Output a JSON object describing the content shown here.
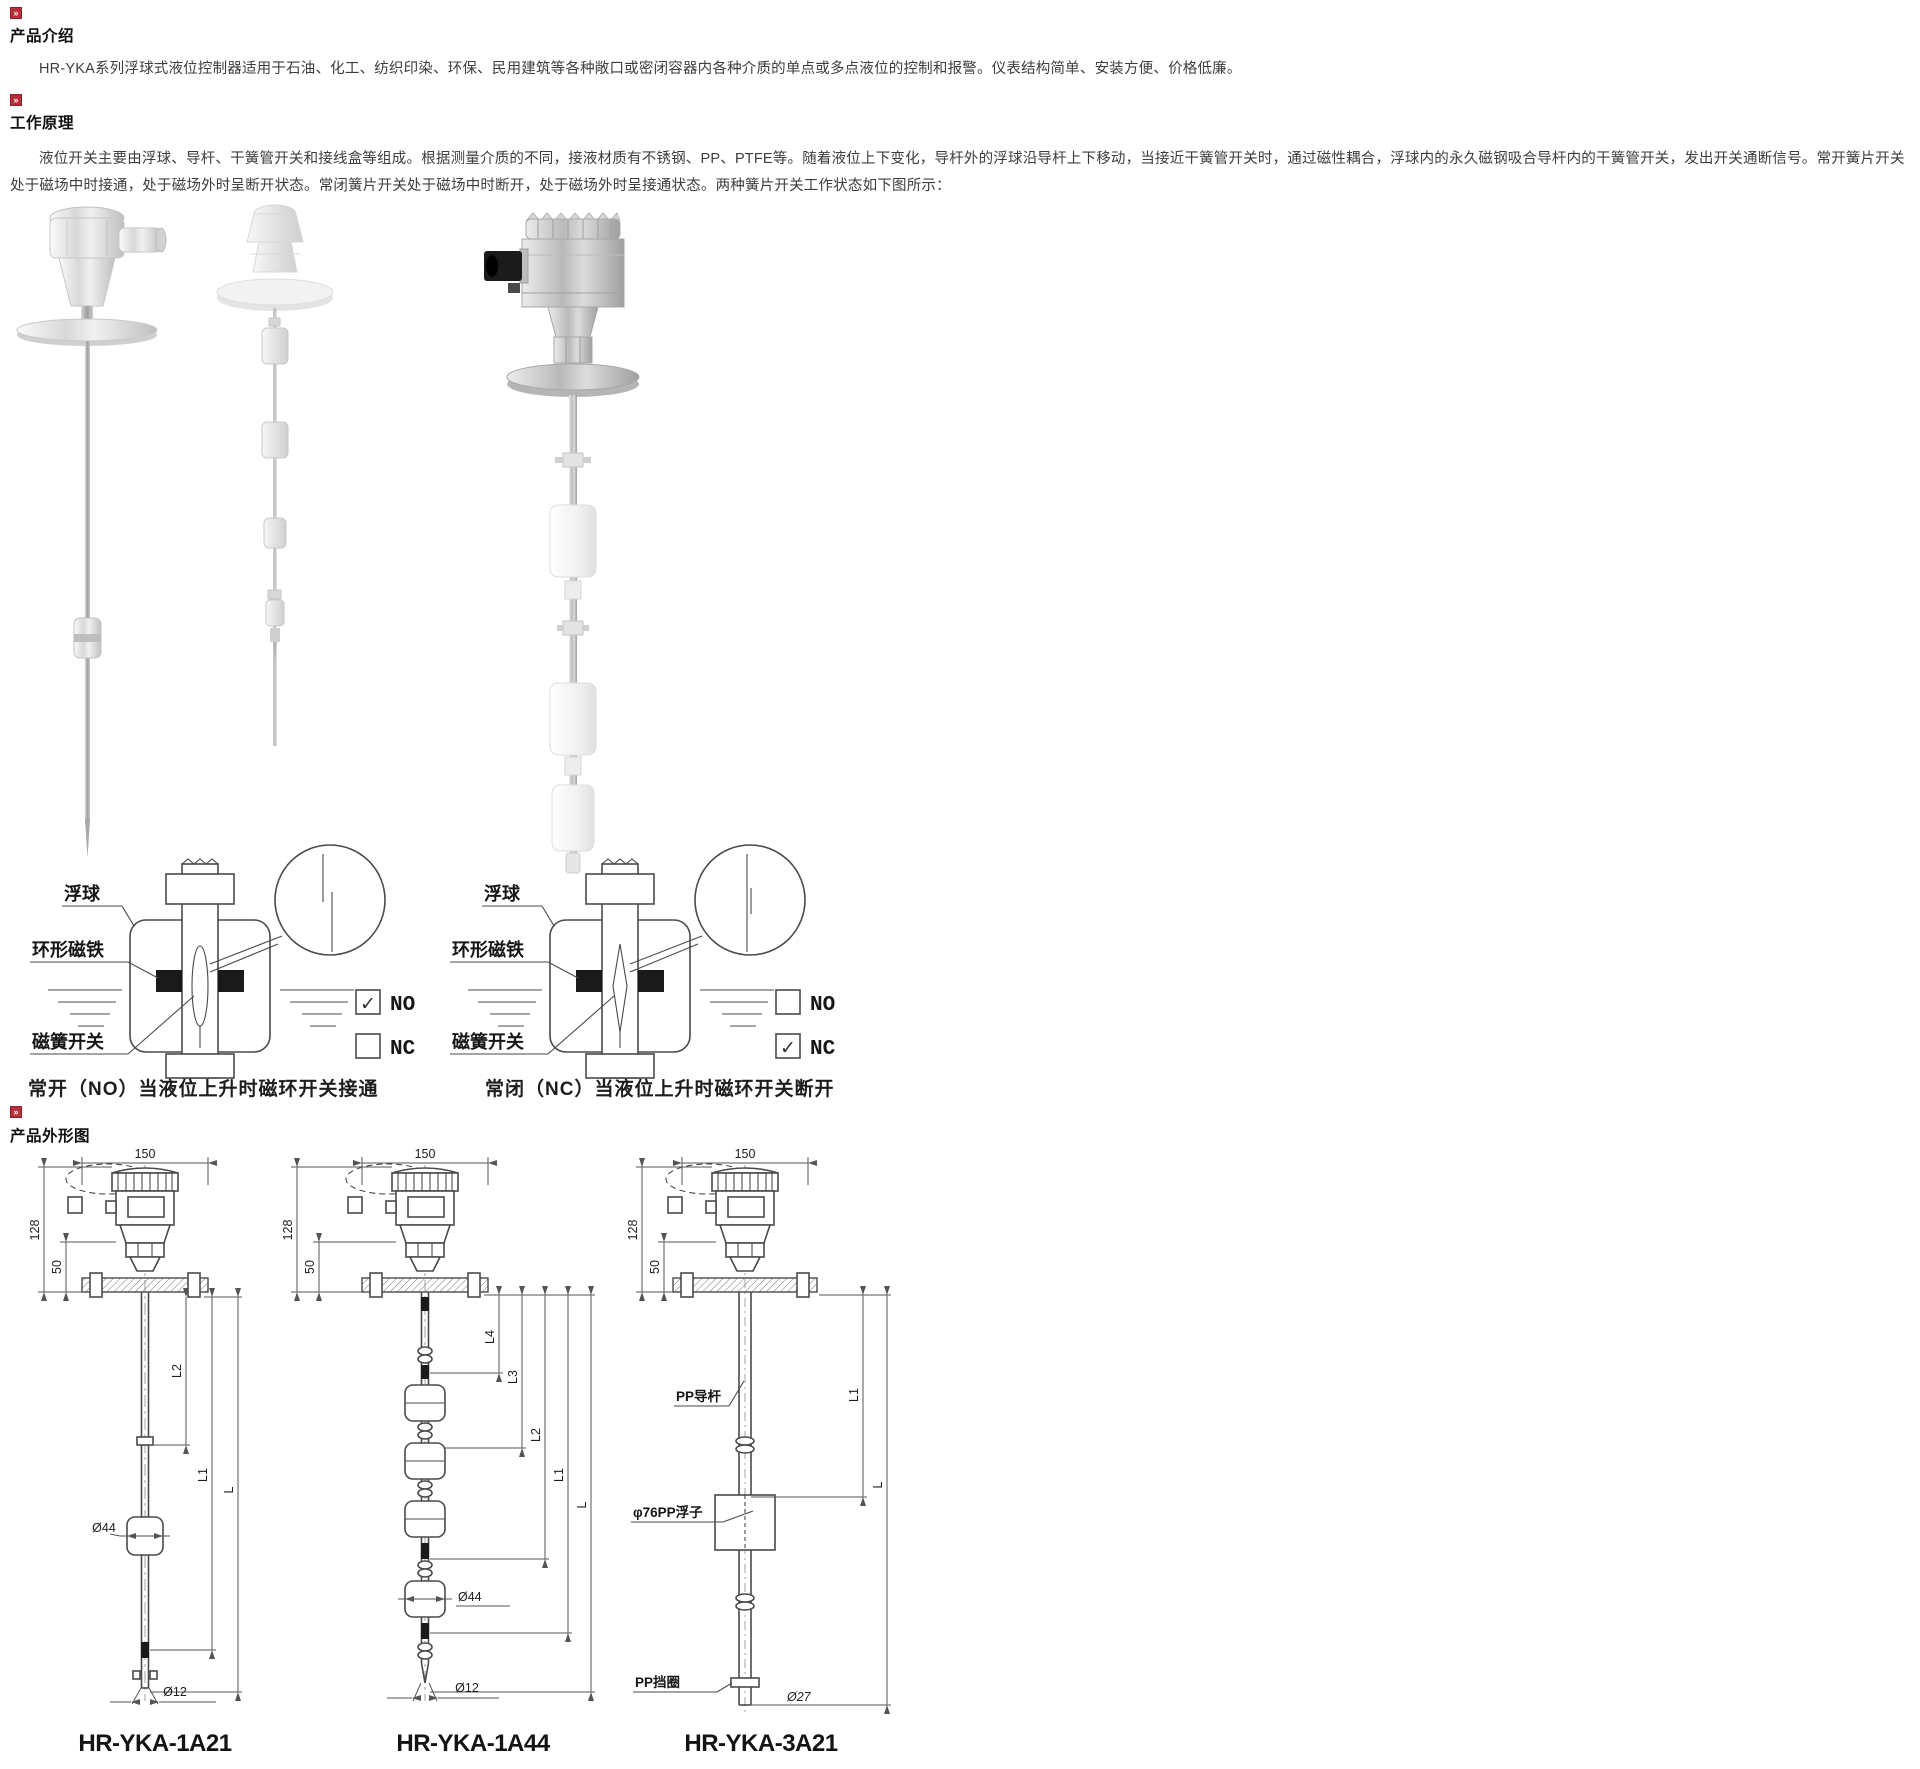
{
  "accent_color": "#b5303a",
  "sections": {
    "intro": {
      "heading": "产品介绍",
      "body": "HR-YKA系列浮球式液位控制器适用于石油、化工、纺织印染、环保、民用建筑等各种敞口或密闭容器内各种介质的单点或多点液位的控制和报警。仪表结构简单、安装方便、价格低廉。"
    },
    "principle": {
      "heading": "工作原理",
      "body": "液位开关主要由浮球、导杆、干簧管开关和接线盒等组成。根据测量介质的不同，接液材质有不锈钢、PP、PTFE等。随着液位上下变化，导杆外的浮球沿导杆上下移动，当接近干簧管开关时，通过磁性耦合，浮球内的永久磁钢吸合导杆内的干簧管开关，发出开关通断信号。常开簧片开关处于磁场中时接通，处于磁场外时呈断开状态。常闭簧片开关处于磁场中时断开，处于磁场外时呈接通状态。两种簧片开关工作状态如下图所示："
    },
    "outline": {
      "heading": "产品外形图"
    }
  },
  "diagram_no": {
    "float_label": "浮球",
    "magnet_label": "环形磁铁",
    "reed_label": "磁簧开关",
    "no_label": "NO",
    "nc_label": "NC",
    "no_check": "✓",
    "nc_check": "",
    "caption": "常开（NO）当液位上升时磁环开关接通"
  },
  "diagram_nc": {
    "float_label": "浮球",
    "magnet_label": "环形磁铁",
    "reed_label": "磁簧开关",
    "no_label": "NO",
    "nc_label": "NC",
    "no_check": "",
    "nc_check": "✓",
    "caption": "常闭（NC）当液位上升时磁环开关断开"
  },
  "drawing1": {
    "model": "HR-YKA-1A21",
    "dim_width": "150",
    "dim_h1": "128",
    "dim_h2": "50",
    "dim_l2": "L2",
    "dim_l1": "L1",
    "dim_l": "L",
    "dim_float": "Ø44",
    "dim_rod": "Ø12"
  },
  "drawing2": {
    "model": "HR-YKA-1A44",
    "dim_width": "150",
    "dim_h1": "128",
    "dim_h2": "50",
    "dim_l4": "L4",
    "dim_l3": "L3",
    "dim_l2": "L2",
    "dim_l1": "L1",
    "dim_l": "L",
    "dim_float": "Ø44",
    "dim_rod": "Ø12"
  },
  "drawing3": {
    "model": "HR-YKA-3A21",
    "dim_width": "150",
    "dim_h1": "128",
    "dim_h2": "50",
    "rod_label": "PP导杆",
    "float_label": "φ76PP浮子",
    "ring_label": "PP挡圈",
    "dim_l1": "L1",
    "dim_l": "L",
    "dim_rod": "Ø27"
  }
}
